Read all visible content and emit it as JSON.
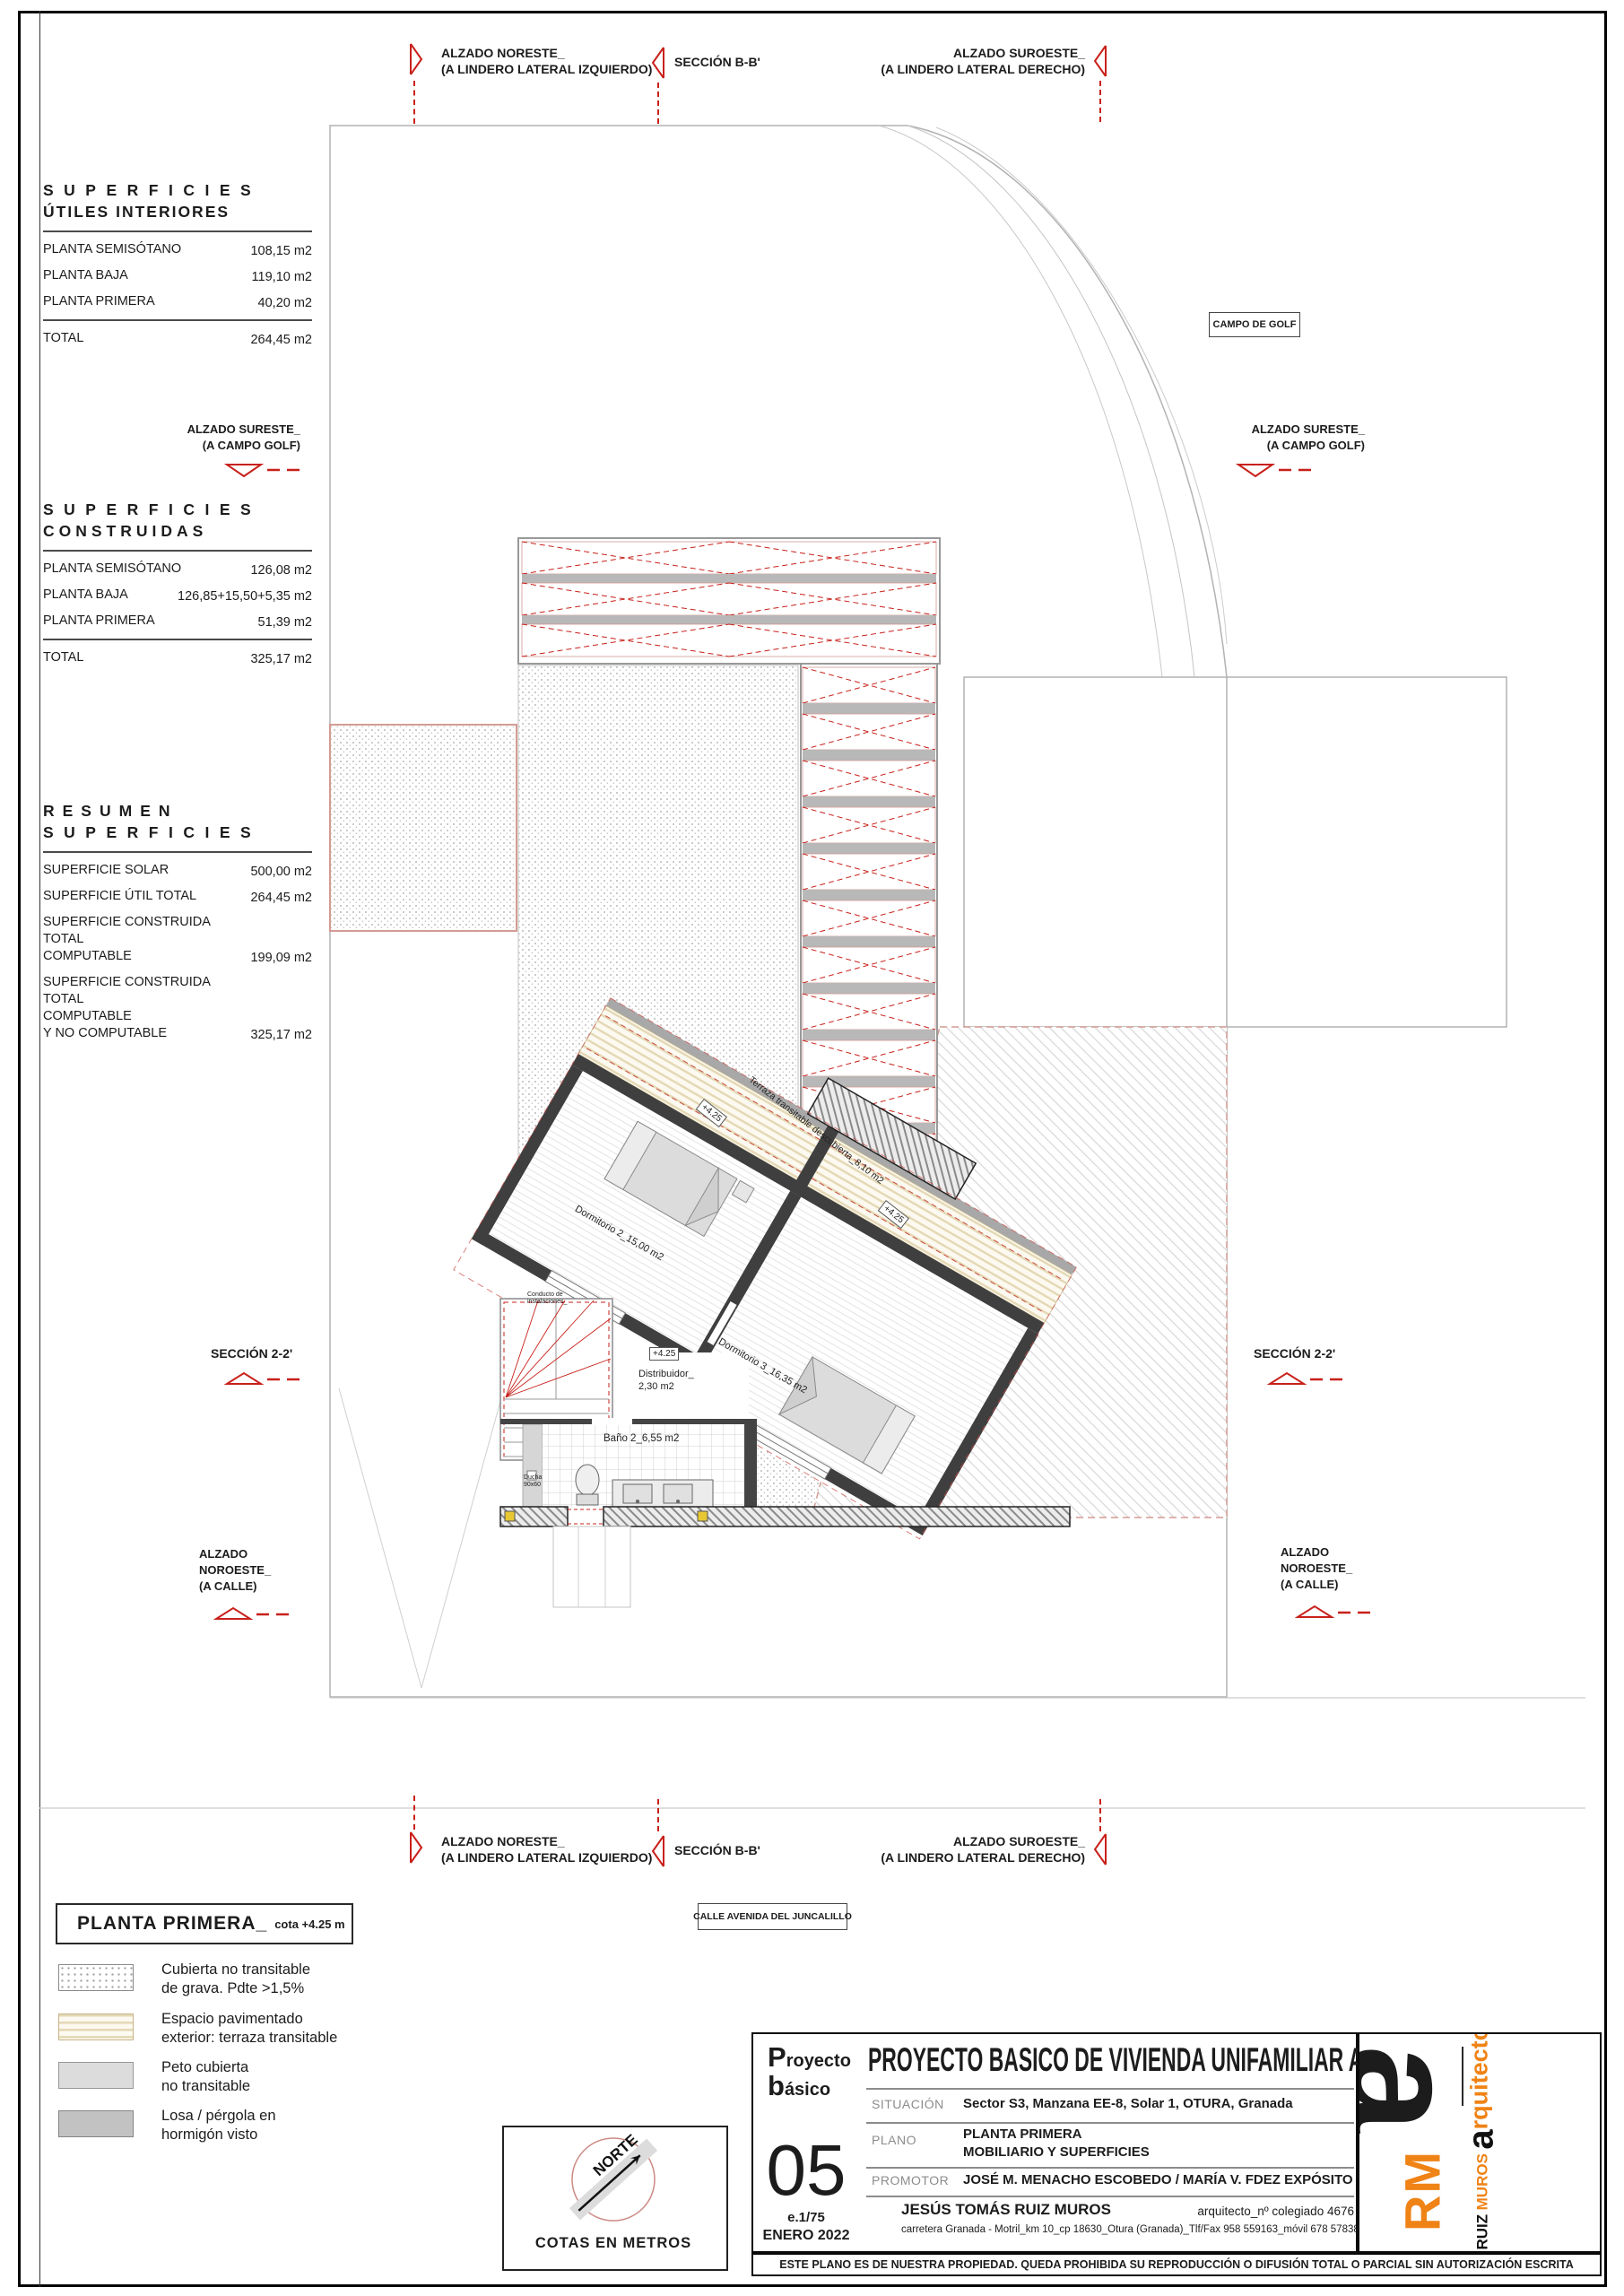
{
  "colors": {
    "accent_red": "#c8201a",
    "logo_orange": "#ef8316",
    "wall_gray": "#3f3f3f"
  },
  "top_markers": {
    "noreste": {
      "l1": "ALZADO NORESTE_",
      "l2": "(A LINDERO LATERAL IZQUIERDO)"
    },
    "seccion_bb": "SECCIÓN B-B'",
    "suroeste": {
      "l1": "ALZADO SUROESTE_",
      "l2": "(A LINDERO LATERAL DERECHO)"
    }
  },
  "side_markers": {
    "sureste": "ALZADO SURESTE_\n(A CAMPO GOLF)",
    "seccion_22": "SECCIÓN 2-2'",
    "noroeste": "ALZADO\nNOROESTE_\n(A CALLE)"
  },
  "boxes": {
    "campo_golf": "CAMPO DE GOLF",
    "calle": "CALLE AVENIDA DEL JUNCALILLO"
  },
  "tables": {
    "utiles": {
      "t1": "SUPERFICIES",
      "t2": "ÚTILES INTERIORES",
      "rows": [
        {
          "label": "PLANTA SEMISÓTANO",
          "value": "108,15 m2"
        },
        {
          "label": "PLANTA BAJA",
          "value": "119,10 m2"
        },
        {
          "label": "PLANTA PRIMERA",
          "value": "40,20 m2"
        }
      ],
      "total_label": "TOTAL",
      "total_value": "264,45 m2"
    },
    "construidas": {
      "t1": "SUPERFICIES",
      "t2": "CONSTRUIDAS",
      "rows": [
        {
          "label": "PLANTA SEMISÓTANO",
          "value": "126,08 m2"
        },
        {
          "label": "PLANTA BAJA",
          "value": "126,85+15,50+5,35 m2"
        },
        {
          "label": "PLANTA PRIMERA",
          "value": "51,39 m2"
        }
      ],
      "total_label": "TOTAL",
      "total_value": "325,17 m2"
    },
    "resumen": {
      "t1": "RESUMEN",
      "t2": "SUPERFICIES",
      "rows": [
        {
          "label": "SUPERFICIE SOLAR",
          "value": "500,00 m2"
        },
        {
          "label": "SUPERFICIE ÚTIL TOTAL",
          "value": "264,45 m2"
        },
        {
          "label": "SUPERFICIE CONSTRUIDA TOTAL\nCOMPUTABLE",
          "value": "199,09 m2"
        },
        {
          "label": "SUPERFICIE CONSTRUIDA TOTAL\nCOMPUTABLE\nY NO COMPUTABLE",
          "value": "325,17 m2"
        }
      ]
    }
  },
  "plan": {
    "dorm2": "Dormitorio 2_15,00 m2",
    "dorm3": "Dormitorio 3_16,35 m2",
    "terraza": "Terraza transitable descubierta_8,10 m2",
    "bano": "Baño 2_6,55 m2",
    "distribuidor": "Distribuidor_\n2,30 m2",
    "ducha": "Ducha\n90x60",
    "conducto": "Conducto de\ninstalaciones_",
    "cota": "+4.25"
  },
  "legend": {
    "title": "PLANTA PRIMERA_",
    "title_note": "cota +4.25 m",
    "items": [
      {
        "label": "Cubierta no transitable\nde grava. Pdte >1,5%"
      },
      {
        "label": "Espacio pavimentado\nexterior: terraza transitable"
      },
      {
        "label": "Peto cubierta\nno transitable"
      },
      {
        "label": "Losa / pérgola en\nhormigón visto"
      }
    ],
    "cotas": "COTAS EN METROS",
    "norte": "NORTE"
  },
  "titleblock": {
    "doc1": "Proyecto",
    "doc2": "básico",
    "title": "PROYECTO BASICO DE VIVIENDA UNIFAMILIAR AISLADA",
    "situacion_label": "SITUACIÓN",
    "situacion": "Sector S3, Manzana EE-8, Solar 1, OTURA, Granada",
    "plano_label": "PLANO",
    "plano1": "PLANTA PRIMERA",
    "plano2": "MOBILIARIO Y SUPERFICIES",
    "promotor_label": "PROMOTOR",
    "promotor": "JOSÉ M. MENACHO ESCOBEDO / MARÍA V. FDEZ EXPÓSITO",
    "sheet": "05",
    "scale": "e.1/75",
    "date": "ENERO 2022",
    "architect": "JESÚS TOMÁS RUIZ MUROS",
    "college": "arquitecto_nº colegiado 4676",
    "address": "carretera Granada - Motril_km 10_cp 18630_Otura (Granada)_Tlf/Fax 958 559163_móvil 678 578388",
    "disclaimer": "ESTE PLANO ES DE NUESTRA PROPIEDAD. QUEDA PROHIBIDA SU REPRODUCCIÓN O DIFUSIÓN TOTAL O PARCIAL  SIN AUTORIZACIÓN ESCRITA",
    "logo": {
      "rm": "RM",
      "a": "a",
      "ruiz": "RUIZ",
      "muros": "MUROS",
      "arq_a": "a",
      "arq_rest": "rquitectos"
    }
  }
}
